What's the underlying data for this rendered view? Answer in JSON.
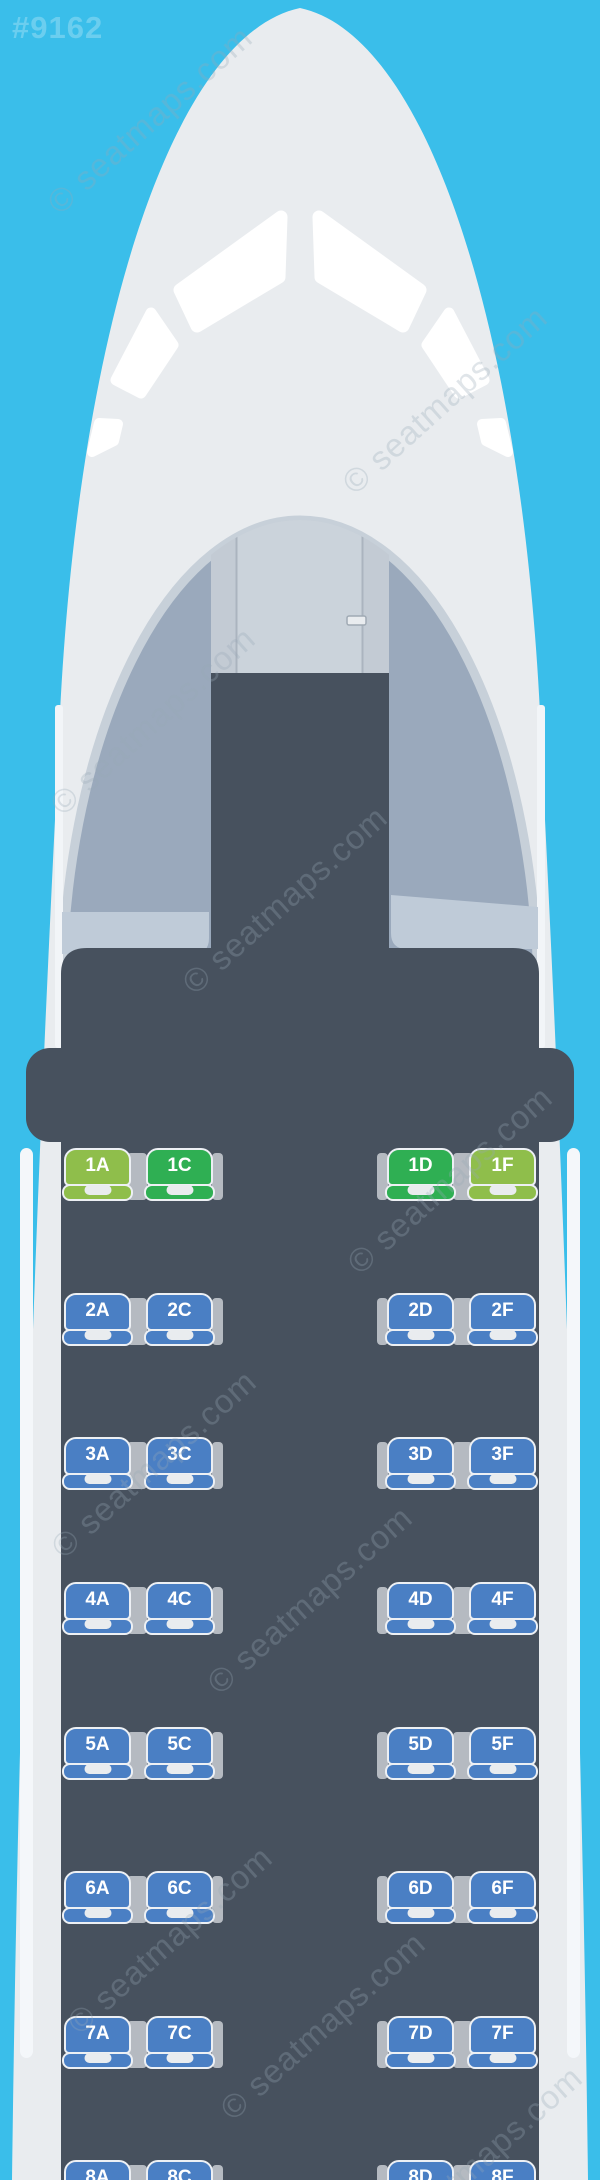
{
  "page": {
    "id_label": "#9162",
    "watermark_text": "© seatmaps.com",
    "background_color": "#3ABEEA"
  },
  "aircraft": {
    "fuselage_color": "#E9ECEF",
    "cabin_color": "#47515E",
    "cockpit_panel_color": "#CBD3DB",
    "cockpit_wedge_color": "#9AA9BC",
    "galley_counter_color": "#BFCBD8",
    "armrest_color": "#B5BAC1",
    "seat_outline_color": "#EDF0F4"
  },
  "seat_map": {
    "columns": [
      "A",
      "C",
      "D",
      "F"
    ],
    "aisle_after_column": "C",
    "seat_colors": {
      "lime": "#8FBE4B",
      "green": "#2FAF53",
      "blue": "#4A7FC4"
    },
    "rows": [
      {
        "row": "1",
        "seats": [
          {
            "label": "1A",
            "color": "lime"
          },
          {
            "label": "1C",
            "color": "green"
          },
          {
            "label": "1D",
            "color": "green"
          },
          {
            "label": "1F",
            "color": "lime"
          }
        ]
      },
      {
        "row": "2",
        "seats": [
          {
            "label": "2A",
            "color": "blue"
          },
          {
            "label": "2C",
            "color": "blue"
          },
          {
            "label": "2D",
            "color": "blue"
          },
          {
            "label": "2F",
            "color": "blue"
          }
        ]
      },
      {
        "row": "3",
        "seats": [
          {
            "label": "3A",
            "color": "blue"
          },
          {
            "label": "3C",
            "color": "blue"
          },
          {
            "label": "3D",
            "color": "blue"
          },
          {
            "label": "3F",
            "color": "blue"
          }
        ]
      },
      {
        "row": "4",
        "seats": [
          {
            "label": "4A",
            "color": "blue"
          },
          {
            "label": "4C",
            "color": "blue"
          },
          {
            "label": "4D",
            "color": "blue"
          },
          {
            "label": "4F",
            "color": "blue"
          }
        ]
      },
      {
        "row": "5",
        "seats": [
          {
            "label": "5A",
            "color": "blue"
          },
          {
            "label": "5C",
            "color": "blue"
          },
          {
            "label": "5D",
            "color": "blue"
          },
          {
            "label": "5F",
            "color": "blue"
          }
        ]
      },
      {
        "row": "6",
        "seats": [
          {
            "label": "6A",
            "color": "blue"
          },
          {
            "label": "6C",
            "color": "blue"
          },
          {
            "label": "6D",
            "color": "blue"
          },
          {
            "label": "6F",
            "color": "blue"
          }
        ]
      },
      {
        "row": "7",
        "seats": [
          {
            "label": "7A",
            "color": "blue"
          },
          {
            "label": "7C",
            "color": "blue"
          },
          {
            "label": "7D",
            "color": "blue"
          },
          {
            "label": "7F",
            "color": "blue"
          }
        ]
      },
      {
        "row": "8",
        "seats": [
          {
            "label": "8A",
            "color": "blue"
          },
          {
            "label": "8C",
            "color": "blue"
          },
          {
            "label": "8D",
            "color": "blue"
          },
          {
            "label": "8F",
            "color": "blue"
          }
        ]
      }
    ]
  }
}
